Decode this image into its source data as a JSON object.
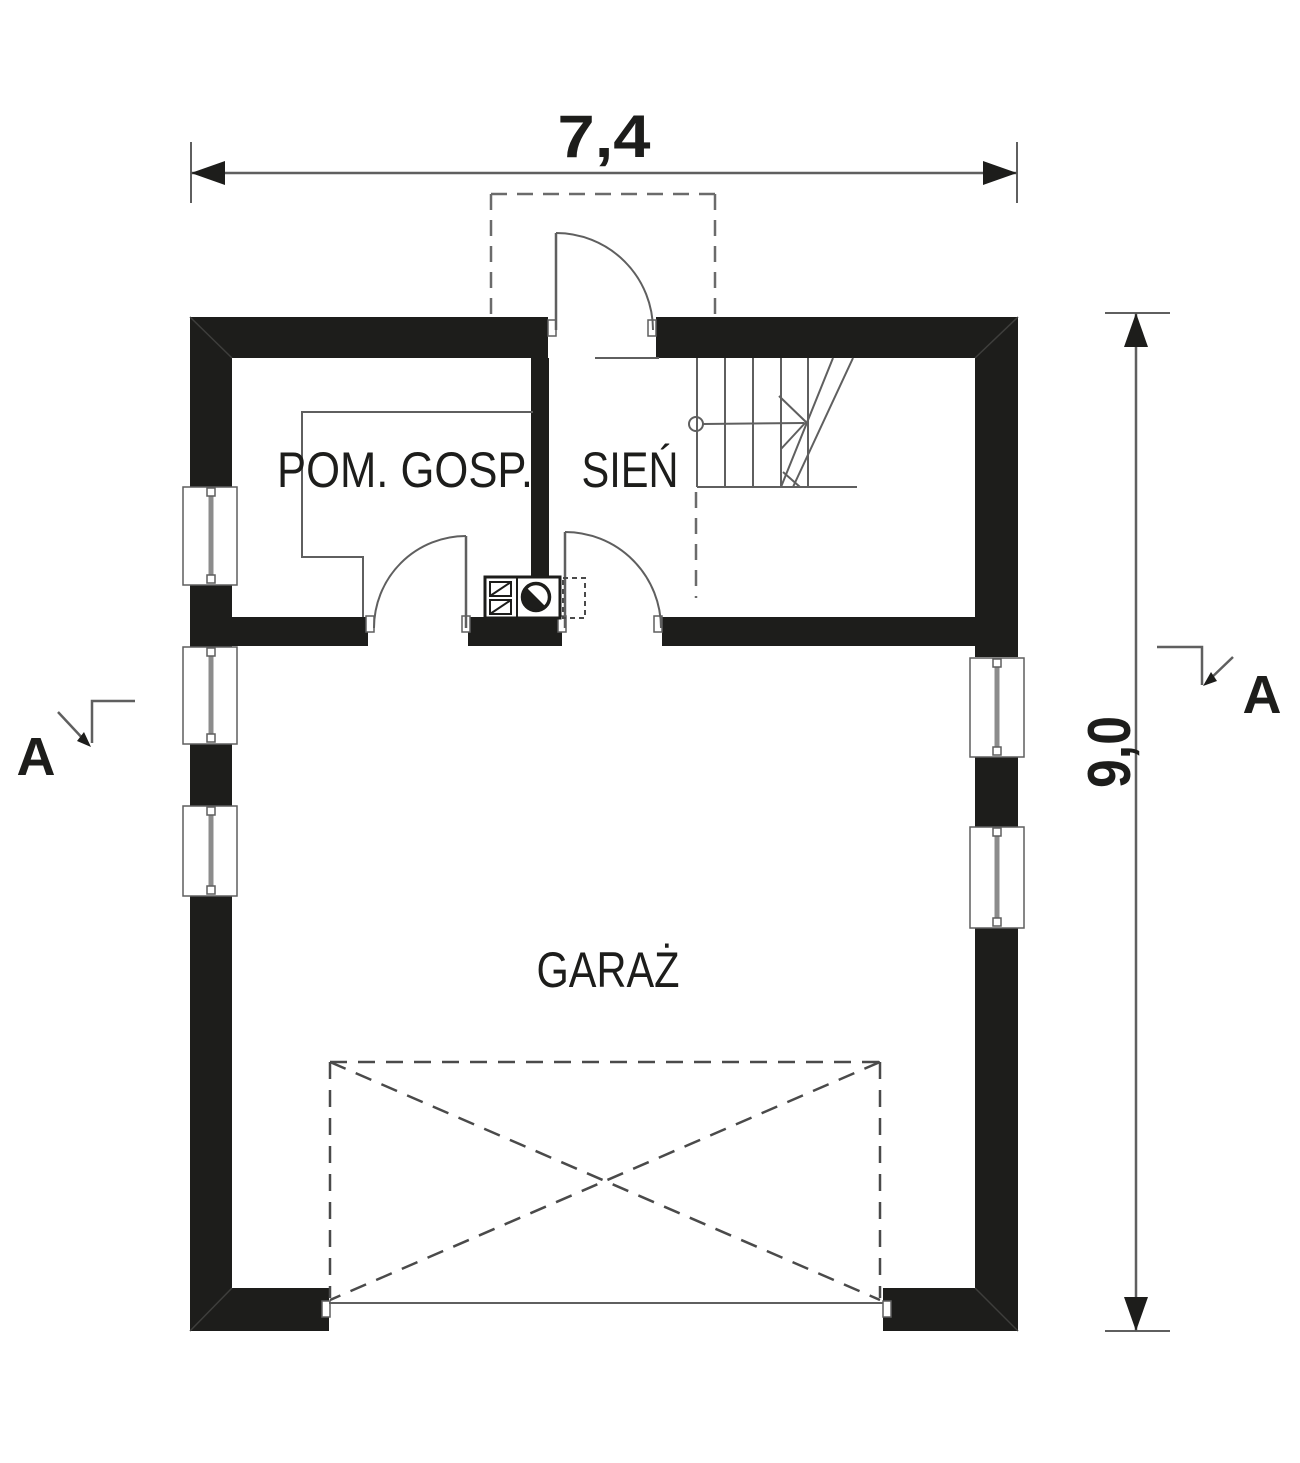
{
  "plan": {
    "rooms": {
      "utility": "POM. GOSP.",
      "hall": "SIEŃ",
      "garage": "GARAŻ"
    },
    "dimensions": {
      "width": "7,4",
      "height": "9,0"
    },
    "section_markers": {
      "left": "A",
      "right": "A"
    },
    "symbols": {
      "staircase": "stairs-up-with-walk-line",
      "boiler": "boiler-stove-symbol",
      "entrance_canopy": "dashed-canopy-outline",
      "garage_door": "dashed-crossed-gate",
      "windows_left_count": 3,
      "windows_right_count": 2
    },
    "colors": {
      "wall": "#1d1d1b",
      "line": "#5f5f5f",
      "dashed_line": "#6b6b6b",
      "text": "#1d1d1b",
      "background": "#ffffff"
    }
  }
}
